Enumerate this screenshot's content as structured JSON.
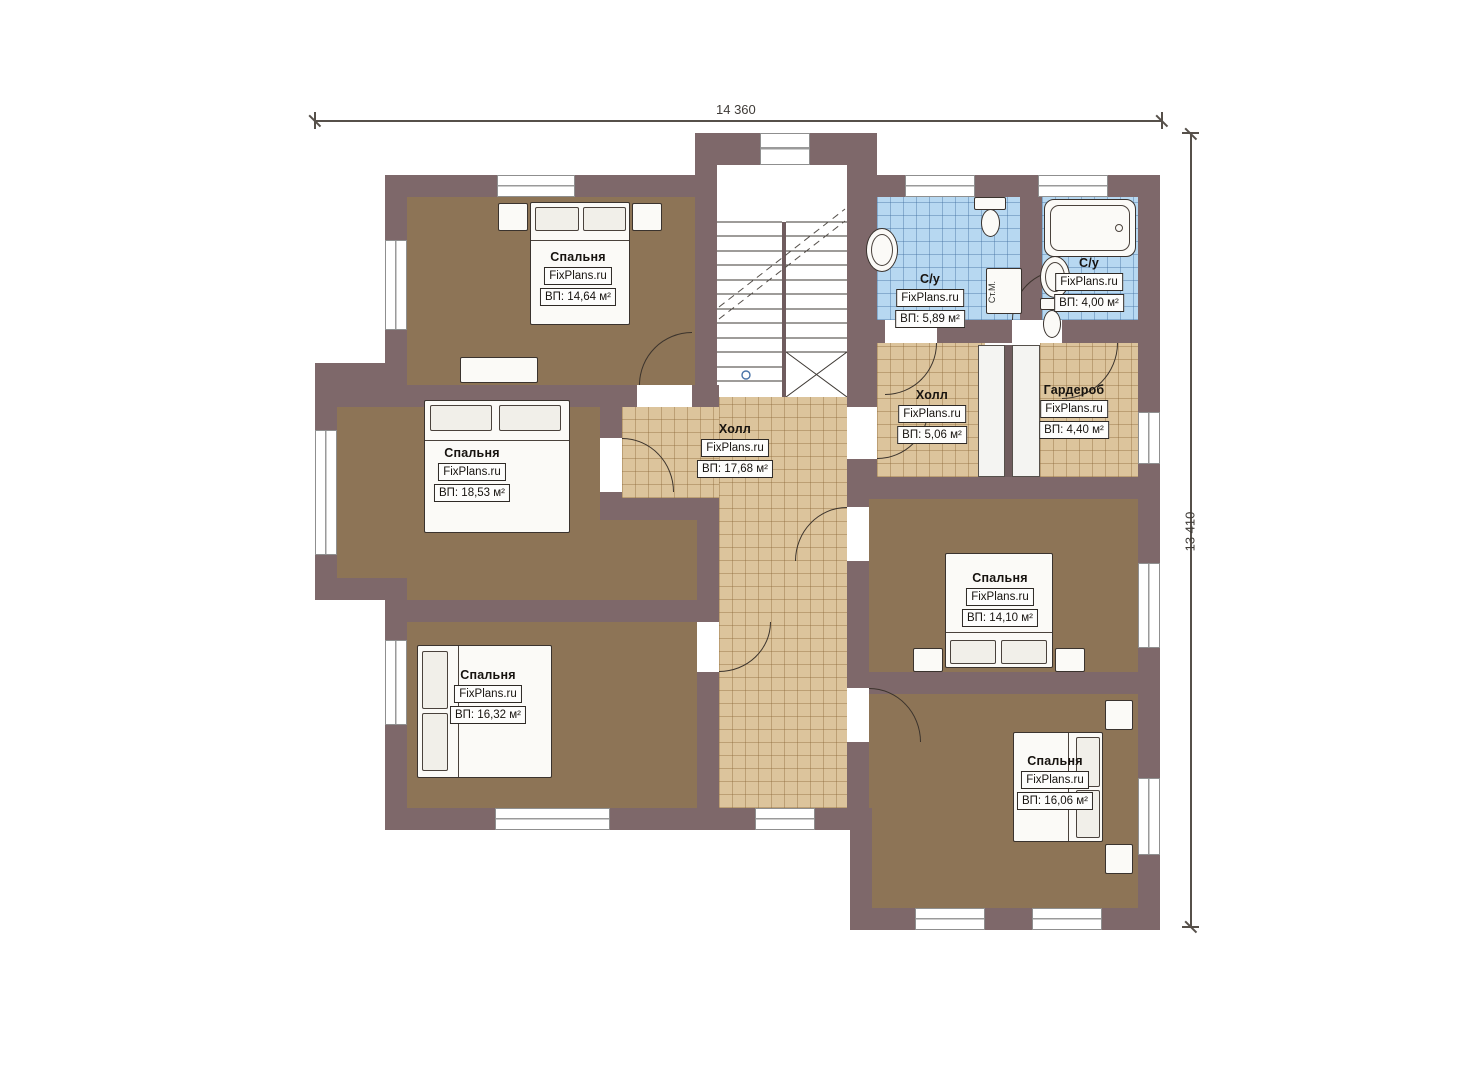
{
  "plan": {
    "title": "floor-plan-second-floor",
    "dimensions": {
      "width": "14 360",
      "height": "13 410"
    },
    "rooms": [
      {
        "name": "Спальня",
        "site": "FixPlans.ru",
        "area": "ВП: 14,64 м²"
      },
      {
        "name": "Спальня",
        "site": "FixPlans.ru",
        "area": "ВП: 18,53 м²"
      },
      {
        "name": "Спальня",
        "site": "FixPlans.ru",
        "area": "ВП: 16,32 м²"
      },
      {
        "name": "Холл",
        "site": "FixPlans.ru",
        "area": "ВП: 17,68 м²"
      },
      {
        "name": "Холл",
        "site": "FixPlans.ru",
        "area": "ВП: 5,06 м²"
      },
      {
        "name": "Гардероб",
        "site": "FixPlans.ru",
        "area": "ВП: 4,40 м²"
      },
      {
        "name": "С/у",
        "site": "FixPlans.ru",
        "area": "ВП: 5,89 м²"
      },
      {
        "name": "С/у",
        "site": "FixPlans.ru",
        "area": "ВП: 4,00 м²"
      },
      {
        "name": "Спальня",
        "site": "FixPlans.ru",
        "area": "ВП: 14,10 м²"
      },
      {
        "name": "Спальня",
        "site": "FixPlans.ru",
        "area": "ВП: 16,06 м²"
      }
    ],
    "appliances": {
      "washer": "Ст.М."
    },
    "colors": {
      "wall": "#7e686a",
      "bedroom_floor": "#8d7456",
      "hall_floor": "#dcc49c",
      "bath_floor": "#b7d8f1"
    }
  }
}
